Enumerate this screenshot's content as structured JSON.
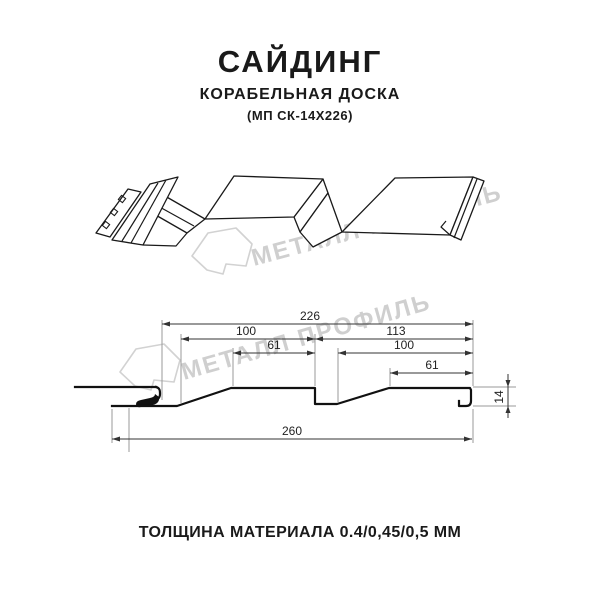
{
  "page": {
    "background": "#ffffff",
    "line_color": "#1a1a1a",
    "watermark_color": "#cfcfcf"
  },
  "header": {
    "title": "САЙДИНГ",
    "subtitle": "КОРАБЕЛЬНАЯ ДОСКА",
    "model": "(МП СК-14Х226)"
  },
  "watermark": {
    "text": "МЕТАЛЛ ПРОФИЛЬ",
    "logo": "metall-profil-house-logo"
  },
  "drawing": {
    "type": "technical-profile-diagram",
    "views": [
      "isometric-3d-view",
      "cross-section-view"
    ],
    "dimensions_mm": {
      "overall_width": 260,
      "module_width": 226,
      "half_module": 113,
      "board_width": 100,
      "board_flat": 61,
      "profile_height": 14
    },
    "labels": {
      "d226": "226",
      "d100l": "100",
      "d61l": "61",
      "d113": "113",
      "d100r": "100",
      "d61r": "61",
      "d260": "260",
      "d14": "14"
    }
  },
  "footer": {
    "text": "ТОЛЩИНА МАТЕРИАЛА 0.4/0,45/0,5 ММ"
  }
}
